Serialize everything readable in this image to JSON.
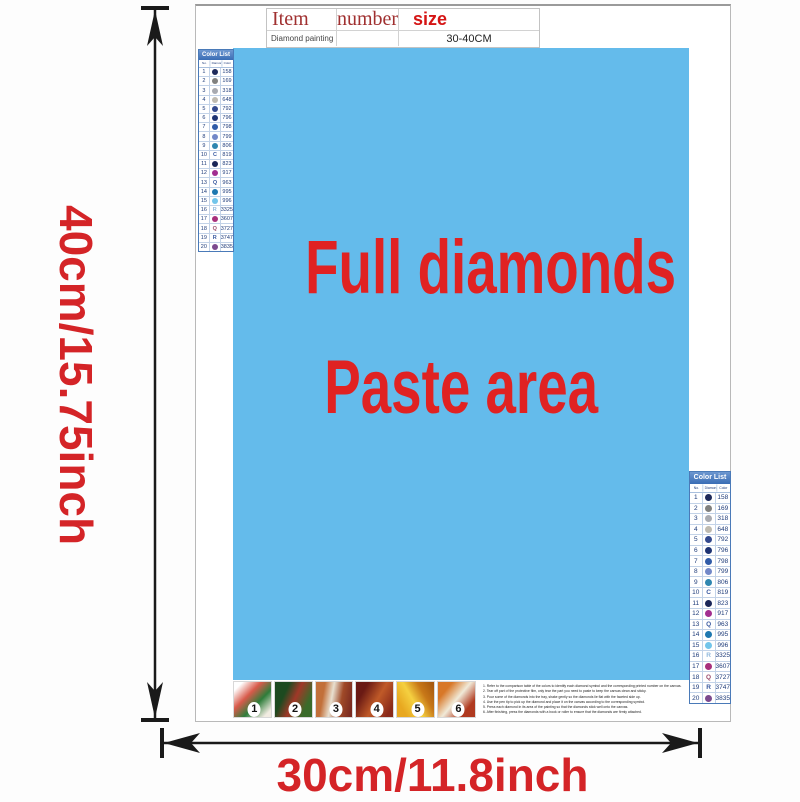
{
  "colors": {
    "paste_blue": "#64bbeb",
    "red_text": "#e02222",
    "dim_red": "#d42427",
    "arrow_black": "#1a1a1a",
    "list_header_bg": "#3a6db5",
    "list_border": "#4a7ab8",
    "list_text": "#1f3c7a",
    "table_header_red": "#d51414",
    "table_maroon": "#a03030"
  },
  "dimensions": {
    "height_label": "40cm/15.75inch",
    "width_label": "30cm/11.8inch"
  },
  "item_table": {
    "headers": [
      "Item",
      "number",
      "size"
    ],
    "row": {
      "item": "Diamond painting",
      "number": "",
      "size": "30-40CM"
    }
  },
  "paste_area": {
    "line1": "Full diamonds",
    "line2": "Paste area"
  },
  "color_list": {
    "title": "Color List",
    "columns": [
      "No.",
      "Diamond",
      "Color"
    ],
    "rows": [
      {
        "no": "1",
        "type": "circle",
        "symbol": "",
        "color": "#1e2a5a",
        "code": "158"
      },
      {
        "no": "2",
        "type": "circle",
        "symbol": "",
        "color": "#80807e",
        "code": "169"
      },
      {
        "no": "3",
        "type": "circle",
        "symbol": "",
        "color": "#a8aab0",
        "code": "318"
      },
      {
        "no": "4",
        "type": "circle",
        "symbol": "",
        "color": "#bebab0",
        "code": "648"
      },
      {
        "no": "5",
        "type": "circle",
        "symbol": "",
        "color": "#33498e",
        "code": "792"
      },
      {
        "no": "6",
        "type": "circle",
        "symbol": "",
        "color": "#1d3373",
        "code": "796"
      },
      {
        "no": "7",
        "type": "circle",
        "symbol": "",
        "color": "#2f5ba8",
        "code": "798"
      },
      {
        "no": "8",
        "type": "circle",
        "symbol": "",
        "color": "#7288c8",
        "code": "799"
      },
      {
        "no": "9",
        "type": "circle",
        "symbol": "",
        "color": "#2e86b0",
        "code": "806"
      },
      {
        "no": "10",
        "type": "letter",
        "symbol": "C",
        "color": "#3a5aa0",
        "code": "819"
      },
      {
        "no": "11",
        "type": "circle",
        "symbol": "",
        "color": "#1a2658",
        "code": "823"
      },
      {
        "no": "12",
        "type": "circle",
        "symbol": "",
        "color": "#a22e90",
        "code": "917"
      },
      {
        "no": "13",
        "type": "letter",
        "symbol": "Q",
        "color": "#3a5aa0",
        "code": "963"
      },
      {
        "no": "14",
        "type": "circle",
        "symbol": "",
        "color": "#1e78b0",
        "code": "995"
      },
      {
        "no": "15",
        "type": "circle",
        "symbol": "",
        "color": "#72c5ea",
        "code": "996"
      },
      {
        "no": "16",
        "type": "letter",
        "symbol": "R",
        "color": "#90b8dc",
        "code": "3325"
      },
      {
        "no": "17",
        "type": "circle",
        "symbol": "",
        "color": "#a8307c",
        "code": "3607"
      },
      {
        "no": "18",
        "type": "letter",
        "symbol": "Q",
        "color": "#9a4a6a",
        "code": "3727"
      },
      {
        "no": "19",
        "type": "letter",
        "symbol": "R",
        "color": "#3a5aa0",
        "code": "3747"
      },
      {
        "no": "20",
        "type": "circle",
        "symbol": "",
        "color": "#7c4a8e",
        "code": "3835"
      }
    ]
  },
  "steps": {
    "numbers": [
      "1",
      "2",
      "3",
      "4",
      "5",
      "6"
    ],
    "instructions": [
      "1. Refer to the comparison table of the colors to identify each diamond symbol and the corresponding printed number on the canvas.",
      "2. Tear off part of the protective film, only tear the part you need to paste to keep the canvas clean and sticky.",
      "3. Pour some of the diamonds into the tray, shake gently so the diamonds lie flat with the faceted side up.",
      "4. Use the pen tip to pick up the diamond and place it on the canvas according to the corresponding symbol.",
      "5. Press each diamond in its area of the painting so that the diamonds stick well onto the canvas.",
      "6. After finishing, press the diamonds with a book or roller to ensure that the diamonds are firmly attached."
    ]
  }
}
